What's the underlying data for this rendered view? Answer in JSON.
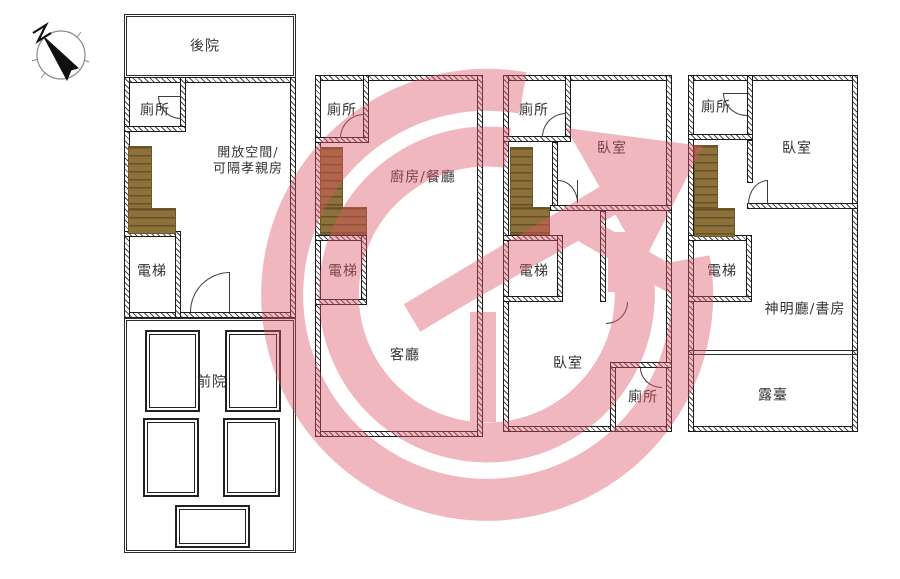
{
  "page": {
    "background": "#ffffff"
  },
  "compass": {
    "name": "north-compass"
  },
  "watermark": {
    "name": "house-logo-watermark",
    "color": "#e05566",
    "opacity": 0.42
  },
  "palette": {
    "wall_line": "#1a1a1a",
    "stair_brown": "#8d713b",
    "label_text": "#333333"
  },
  "floors": [
    {
      "name": "first-floor-plan",
      "labels": {
        "backyard": "後院",
        "toilet": "廁所",
        "open_space_line1": "開放空間/",
        "open_space_line2": "可隔孝親房",
        "elevator": "電梯",
        "front_yard": "前院"
      }
    },
    {
      "name": "second-floor-plan",
      "labels": {
        "toilet": "廁所",
        "kitchen_dining": "廚房/餐廳",
        "elevator": "電梯",
        "living_room": "客廳"
      }
    },
    {
      "name": "third-floor-plan",
      "labels": {
        "toilet_upper": "廁所",
        "bedroom_upper": "臥室",
        "elevator": "電梯",
        "bedroom_lower": "臥室",
        "toilet_lower": "廁所"
      }
    },
    {
      "name": "fourth-floor-plan",
      "labels": {
        "toilet": "廁所",
        "bedroom": "臥室",
        "elevator": "電梯",
        "shrine_study": "神明廳/書房",
        "terrace": "露臺"
      }
    }
  ]
}
